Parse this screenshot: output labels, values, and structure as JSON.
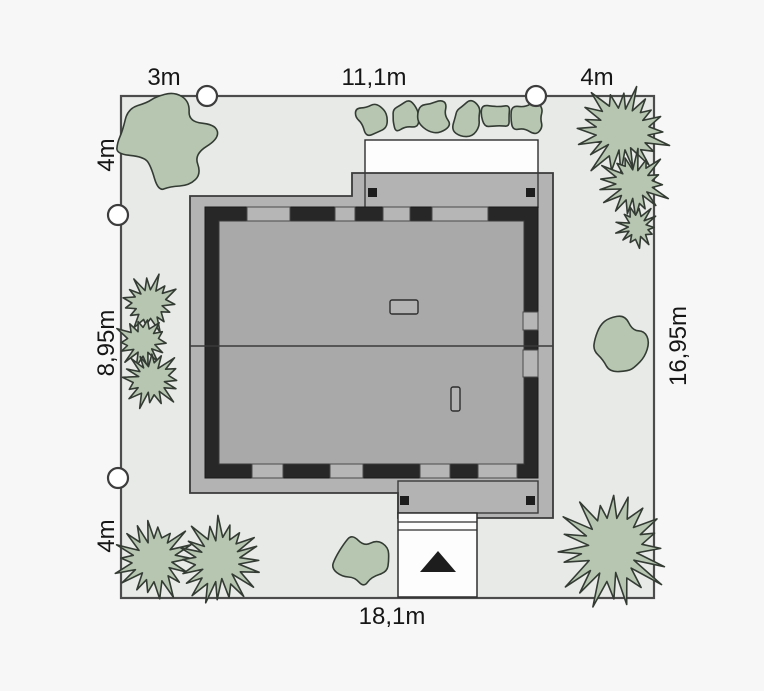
{
  "plan": {
    "type": "house-site-plan",
    "dimensions": {
      "items": [
        {
          "text": "3m",
          "edge": "top-left-segment"
        },
        {
          "text": "11,1m",
          "edge": "top-middle-segment"
        },
        {
          "text": "4m",
          "edge": "top-right-segment"
        },
        {
          "text": "4m",
          "edge": "left-top-segment"
        },
        {
          "text": "8,95m",
          "edge": "left-middle-segment"
        },
        {
          "text": "4m",
          "edge": "left-bottom-segment"
        },
        {
          "text": "16,95m",
          "edge": "right-full-segment"
        },
        {
          "text": "18,1m",
          "edge": "bottom-full-segment"
        }
      ]
    },
    "colors": {
      "background": "#f7f7f7",
      "lot_fill": "#e8eae8",
      "lot_border": "#4c4c4c",
      "roof": "#b3b3b3",
      "house_interior": "#a9a9a9",
      "wall": "#272727",
      "window": "#b6b6b6",
      "terrace_white": "#fdfdfd",
      "tree_fill": "#b6c6b1",
      "tree_stroke": "#333b33",
      "marker_fill": "#ffffff",
      "label_text": "#161616",
      "entrance_arrow": "#1d1d1d"
    },
    "site": {
      "entrance_arrow": "triangle-up",
      "markers": [
        {
          "x": 207,
          "y": 96
        },
        {
          "x": 536,
          "y": 96
        },
        {
          "x": 118,
          "y": 215
        },
        {
          "x": 118,
          "y": 478
        }
      ],
      "trees": [
        {
          "type": "round",
          "x": 166,
          "y": 141,
          "r": 51,
          "seed": 3
        },
        {
          "type": "round",
          "x": 371,
          "y": 118,
          "r": 19,
          "seed": 11
        },
        {
          "type": "round",
          "x": 403,
          "y": 116,
          "r": 19,
          "seed": 12
        },
        {
          "type": "round",
          "x": 434,
          "y": 115,
          "r": 20,
          "seed": 13
        },
        {
          "type": "round",
          "x": 466,
          "y": 117,
          "r": 20,
          "seed": 14
        },
        {
          "type": "round",
          "x": 497,
          "y": 116,
          "r": 19,
          "seed": 15
        },
        {
          "type": "round",
          "x": 528,
          "y": 118,
          "r": 20,
          "seed": 16
        },
        {
          "type": "spiky",
          "x": 622,
          "y": 131,
          "r": 47,
          "seed": 21
        },
        {
          "type": "spiky",
          "x": 634,
          "y": 184,
          "r": 34,
          "seed": 22
        },
        {
          "type": "spiky",
          "x": 637,
          "y": 227,
          "r": 21,
          "seed": 23
        },
        {
          "type": "spiky",
          "x": 149,
          "y": 303,
          "r": 29,
          "seed": 31
        },
        {
          "type": "spiky",
          "x": 143,
          "y": 342,
          "r": 27,
          "seed": 32
        },
        {
          "type": "spiky",
          "x": 151,
          "y": 379,
          "r": 31,
          "seed": 33
        },
        {
          "type": "round",
          "x": 622,
          "y": 344,
          "r": 30,
          "seed": 41
        },
        {
          "type": "round",
          "x": 362,
          "y": 562,
          "r": 30,
          "seed": 42
        },
        {
          "type": "spiky",
          "x": 154,
          "y": 559,
          "r": 39,
          "seed": 51
        },
        {
          "type": "spiky",
          "x": 219,
          "y": 561,
          "r": 44,
          "seed": 52
        },
        {
          "type": "spiky",
          "x": 612,
          "y": 549,
          "r": 56,
          "seed": 53
        }
      ]
    }
  }
}
